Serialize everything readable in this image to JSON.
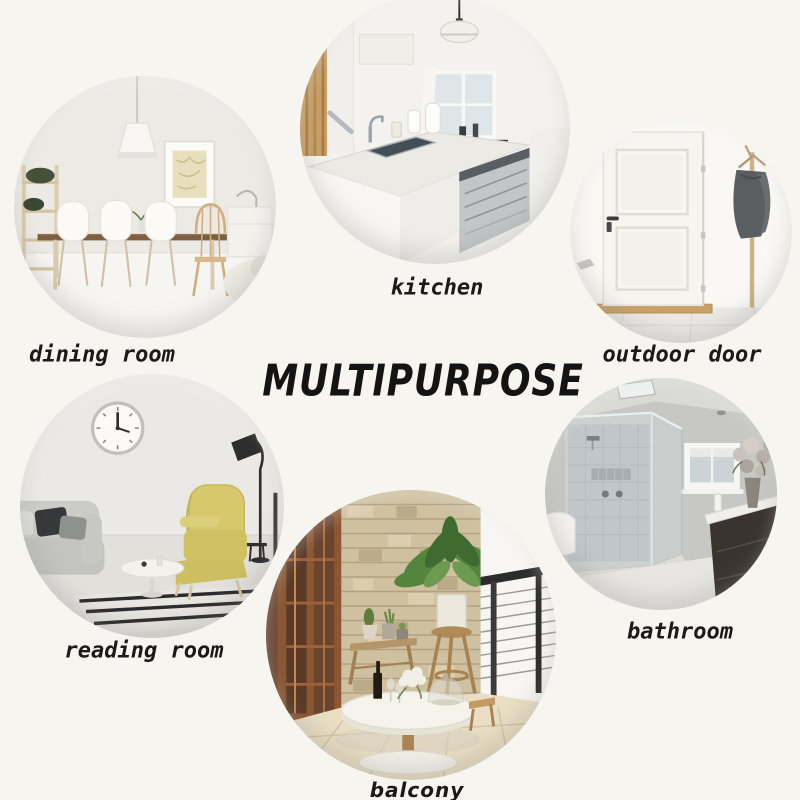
{
  "page": {
    "background_color": "#f7f5f0"
  },
  "title": {
    "text": "MULTIPURPOSE",
    "color": "#141414"
  },
  "rooms": [
    {
      "id": "dining-room",
      "label": "dining room",
      "photo_alt": "white dining room with cone pendant lamp, framed art, ladder plant shelf, wooden dining table, white shell chairs and a windsor chair"
    },
    {
      "id": "kitchen",
      "label": "kitchen",
      "photo_alt": "white kitchen island with grey counter, sink and faucet, white jugs, dome pendant lamp, stainless dishwasher, wooden stair wall on left"
    },
    {
      "id": "outdoor-door",
      "label": "outdoor door",
      "photo_alt": "white panelled entrance door with dark handle, wooden threshold and a coat stand with a grey coat"
    },
    {
      "id": "reading-room",
      "label": "reading room",
      "photo_alt": "reading corner with wall clock, yellow wingback chair with chaise, black floor lamp, grey sofa with pillows, white side table and striped rug"
    },
    {
      "id": "bathroom",
      "label": "bathroom",
      "photo_alt": "grey bathroom with frameless glass walk-in shower, window, ceiling vent and dark vanity with flowers"
    },
    {
      "id": "balcony",
      "label": "balcony",
      "photo_alt": "balcony with stacked stone wall, tall potted plant on wooden stand, bench with small pots, white round table with wine and flowers, cable railing"
    }
  ],
  "palette": {
    "background": "#f7f5f0",
    "title_color": "#141414",
    "label_color": "#1a1a1a",
    "chair_yellow": "#d6c86c",
    "wood_tone": "#c9a268",
    "stone_wall": "#cfc0a0",
    "coat_gray": "#5b5e61",
    "glass_gray": "#aeb5ba"
  }
}
